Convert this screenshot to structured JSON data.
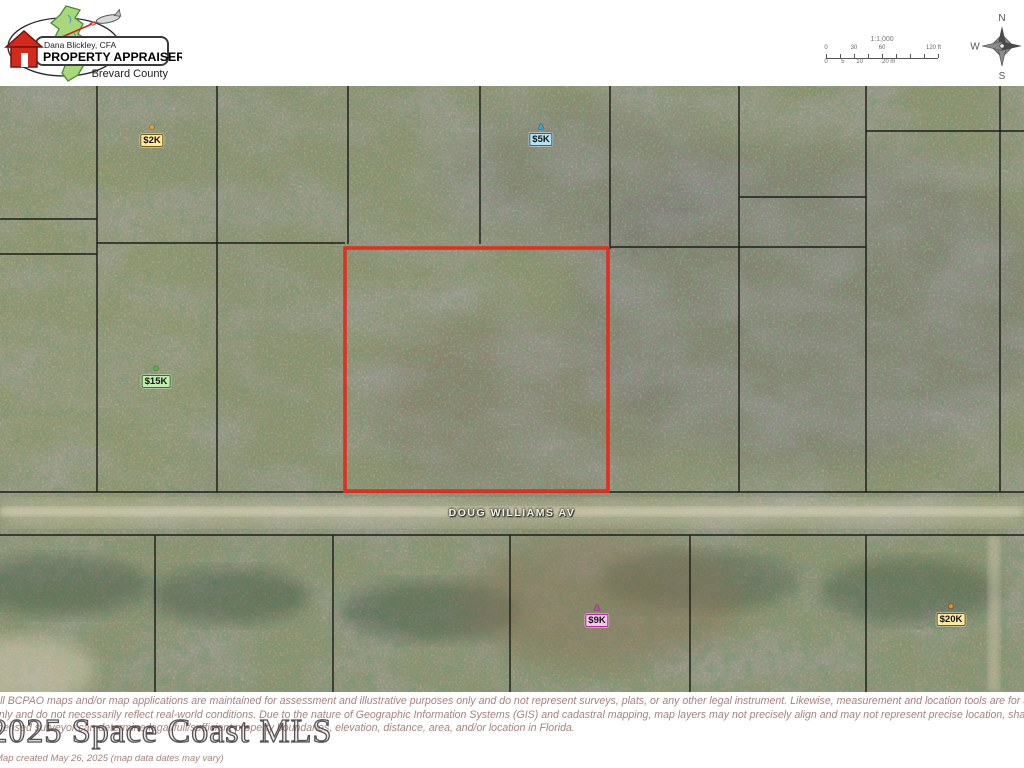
{
  "header": {
    "logo": {
      "name": "Dana Blickley, CFA",
      "title": "PROPERTY APPRAISER",
      "county": "Brevard County"
    },
    "scalebar": {
      "ratio": "1:1,000",
      "ft_ticks": [
        {
          "label": "0",
          "pos": 0
        },
        {
          "label": "30",
          "pos": 25
        },
        {
          "label": "60",
          "pos": 50
        },
        {
          "label": "120 ft",
          "pos": 96
        }
      ],
      "m_ticks": [
        {
          "label": "0",
          "pos": 0
        },
        {
          "label": "5",
          "pos": 15
        },
        {
          "label": "10",
          "pos": 30
        },
        {
          "label": "20 m",
          "pos": 56
        }
      ]
    },
    "compass": {
      "north": "N",
      "south": "S",
      "east": "E",
      "west": "W"
    }
  },
  "map": {
    "road_label": "DOUG WILLIAMS AV",
    "highlight_color": "#e0301f",
    "boundary_color": "#1d1d1d",
    "parcel_outline": {
      "x": 345,
      "y": 162,
      "w": 263,
      "h": 243
    },
    "boundary_segments": [
      {
        "x1": 97,
        "y1": 0,
        "x2": 97,
        "y2": 406
      },
      {
        "x1": 217,
        "y1": 0,
        "x2": 217,
        "y2": 406
      },
      {
        "x1": 348,
        "y1": 0,
        "x2": 348,
        "y2": 158
      },
      {
        "x1": 480,
        "y1": 0,
        "x2": 480,
        "y2": 158
      },
      {
        "x1": 610,
        "y1": 0,
        "x2": 610,
        "y2": 163
      },
      {
        "x1": 739,
        "y1": 0,
        "x2": 739,
        "y2": 406
      },
      {
        "x1": 866,
        "y1": 0,
        "x2": 866,
        "y2": 406
      },
      {
        "x1": 1000,
        "y1": 0,
        "x2": 1000,
        "y2": 406
      },
      {
        "x1": 0,
        "y1": 133,
        "x2": 97,
        "y2": 133
      },
      {
        "x1": 0,
        "y1": 168,
        "x2": 97,
        "y2": 168
      },
      {
        "x1": 97,
        "y1": 157,
        "x2": 345,
        "y2": 157
      },
      {
        "x1": 610,
        "y1": 161,
        "x2": 866,
        "y2": 161
      },
      {
        "x1": 739,
        "y1": 111,
        "x2": 866,
        "y2": 111
      },
      {
        "x1": 866,
        "y1": 45,
        "x2": 1024,
        "y2": 45
      },
      {
        "x1": 0,
        "y1": 406,
        "x2": 1024,
        "y2": 406
      },
      {
        "x1": 0,
        "y1": 449,
        "x2": 1024,
        "y2": 449
      },
      {
        "x1": 155,
        "y1": 449,
        "x2": 155,
        "y2": 606
      },
      {
        "x1": 333,
        "y1": 449,
        "x2": 333,
        "y2": 606
      },
      {
        "x1": 510,
        "y1": 449,
        "x2": 510,
        "y2": 606
      },
      {
        "x1": 690,
        "y1": 449,
        "x2": 690,
        "y2": 606
      },
      {
        "x1": 866,
        "y1": 449,
        "x2": 866,
        "y2": 606
      }
    ],
    "markers": [
      {
        "id": "2k",
        "label": "$2K",
        "shape": "circle",
        "x": 152,
        "top": 37,
        "marker_color": "#eda229",
        "label_bg": "#ffe9a0",
        "border_color": "#7a5c10"
      },
      {
        "id": "5k",
        "label": "$5K",
        "shape": "triangle",
        "x": 541,
        "top": 36,
        "marker_color": "#2aa7e0",
        "label_bg": "#b5e3f4",
        "border_color": "#1e6fa8"
      },
      {
        "id": "15k",
        "label": "$15K",
        "shape": "circle",
        "x": 156,
        "top": 278,
        "marker_color": "#35c53a",
        "label_bg": "#c0efad",
        "border_color": "#2d7a1f"
      },
      {
        "id": "9k",
        "label": "$9K",
        "shape": "triangle",
        "x": 597,
        "top": 517,
        "marker_color": "#cf3ec9",
        "label_bg": "#f7c7ec",
        "border_color": "#b32ba0"
      },
      {
        "id": "20k",
        "label": "$20K",
        "shape": "circle",
        "x": 951,
        "top": 516,
        "marker_color": "#ef8c1f",
        "label_bg": "#ffe9a0",
        "border_color": "#7a5c10"
      }
    ]
  },
  "footer": {
    "disclaimer_lines": [
      "All BCPAO maps and/or map applications are maintained for assessment and illustrative purposes only and do not represent surveys, plats, or any other legal instrument. Likewise, measurement and location tools are for assessment and illustrative purposes only",
      "only and do not necessarily reflect real-world conditions. Due to the nature of Geographic Information Systems (GIS) and cadastral mapping, map layers may not precisely align and may not represent precise location, shape, and/or legal boundaries. Only a",
      "licensed surveyor can determine legal/full/sufficient property boundaries, elevation, distance, area, and/or location in Florida."
    ],
    "map_created": "Map created May 26, 2025 (map data dates may vary)",
    "watermark": "© 2025 Space Coast MLS"
  }
}
